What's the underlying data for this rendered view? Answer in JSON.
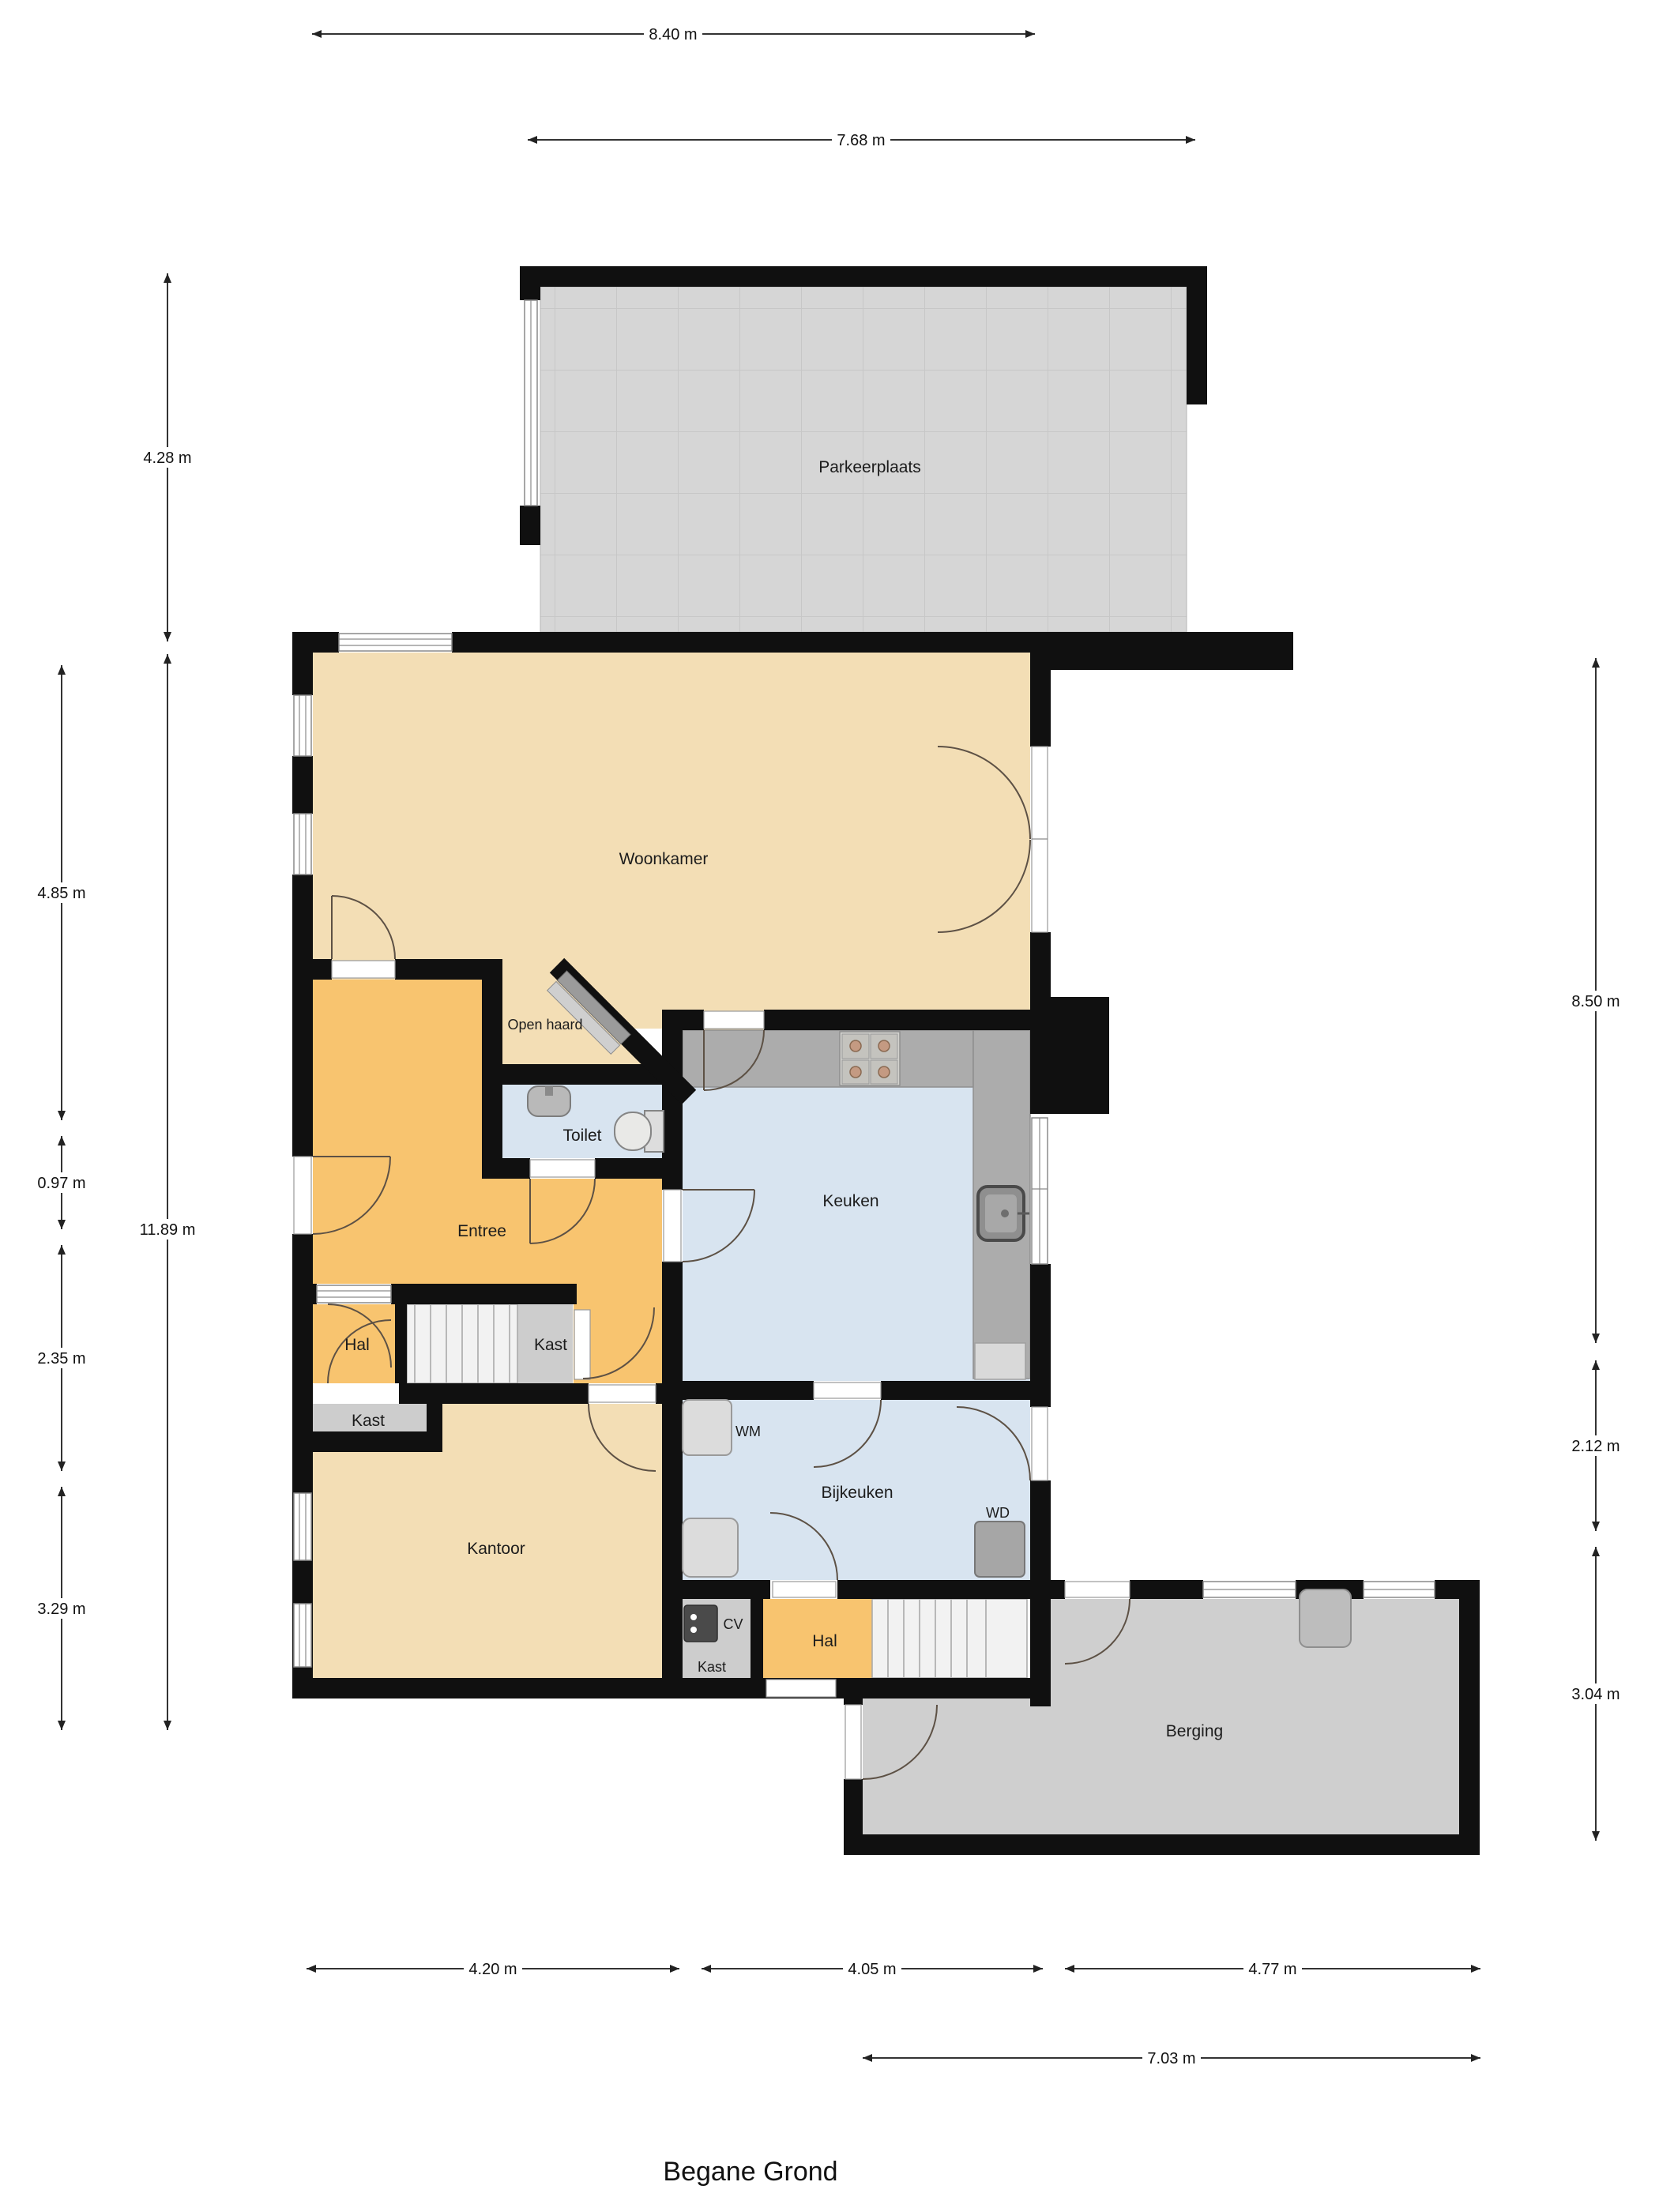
{
  "title": "Begane Grond",
  "labels": {
    "rooms": {
      "parkeerplaats": "Parkeerplaats",
      "woonkamer": "Woonkamer",
      "keuken": "Keuken",
      "toilet": "Toilet",
      "entree": "Entree",
      "hal_upper": "Hal",
      "kast_stairs": "Kast",
      "kast_pocket": "Kast",
      "kantoor": "Kantoor",
      "bijkeuken": "Bijkeuken",
      "hal_lower": "Hal",
      "kast_cv": "Kast",
      "berging": "Berging"
    },
    "features": {
      "open_haard": "Open haard",
      "wm": "WM",
      "wd": "WD",
      "cv": "CV"
    }
  },
  "dimensions": {
    "house_top_width": "8.40 m",
    "parkeerplaats_width": "7.68 m",
    "parkeerplaats_height": "4.28 m",
    "woonkamer_height": "4.85 m",
    "toilet_strip_height": "0.97 m",
    "entree_height": "2.35 m",
    "kantoor_height": "3.29 m",
    "house_total_height": "11.89 m",
    "right_upper_height": "8.50 m",
    "bijkeuken_height": "2.12 m",
    "berging_height": "3.04 m",
    "kantoor_width": "4.20 m",
    "keuken_width": "4.05 m",
    "berging_width": "4.77 m",
    "berging_total_width": "7.03 m"
  },
  "colors": {
    "wall": "#101010",
    "floor_tan": "#F3DEB5",
    "floor_orange": "#F8C46F",
    "floor_blue": "#D8E4F0",
    "floor_parking": "#D6D6D6",
    "floor_berging": "#CFCFCF",
    "counter": "#ACACAC",
    "closet": "#CDCDCD"
  }
}
